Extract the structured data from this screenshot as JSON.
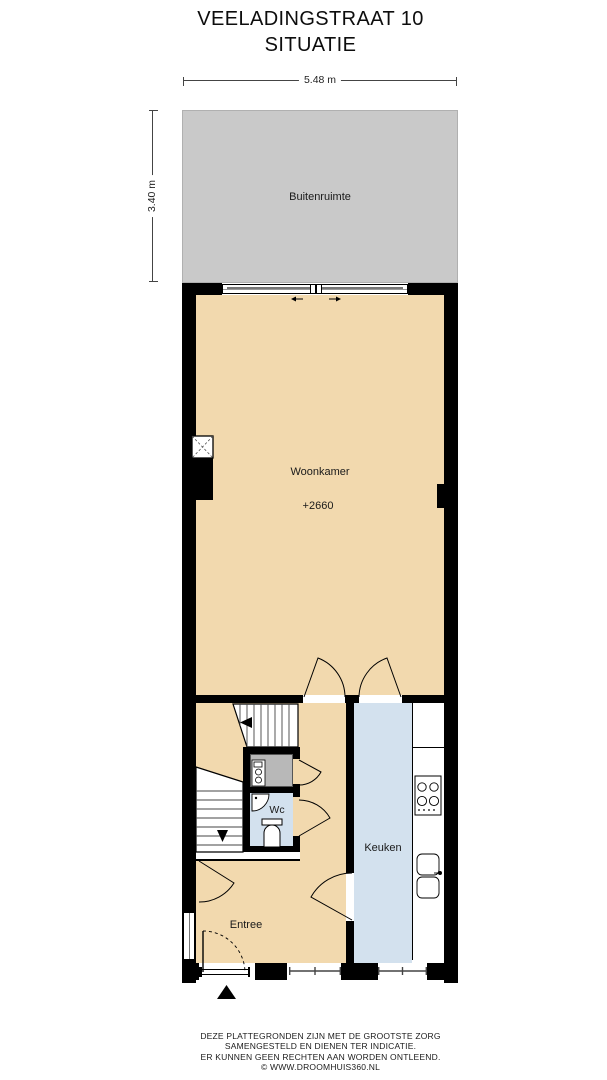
{
  "title": {
    "line1": "VEELADINGSTRAAT 10",
    "line2": "SITUATIE"
  },
  "dimensions": {
    "width": "5.48 m",
    "depth": "3.40 m"
  },
  "rooms": {
    "buitenruimte": {
      "label": "Buitenruimte"
    },
    "woonkamer": {
      "label": "Woonkamer",
      "level": "+2660"
    },
    "wc": {
      "label": "Wc"
    },
    "keuken": {
      "label": "Keuken"
    },
    "entree": {
      "label": "Entree"
    }
  },
  "footer": {
    "line1": "DEZE PLATTEGRONDEN ZIJN MET DE GROOTSTE ZORG",
    "line2": "SAMENGESTELD EN DIENEN TER INDICATIE.",
    "line3": "ER KUNNEN GEEN RECHTEN AAN WORDEN ONTLEEND.",
    "line4": "© WWW.DROOMHUIS360.NL"
  },
  "colors": {
    "wall": "#000000",
    "living_floor": "#f2d9ae",
    "wet_floor": "#d3e1ee",
    "outdoor": "#c9c9c9",
    "cabinet": "#b8b8b8"
  }
}
